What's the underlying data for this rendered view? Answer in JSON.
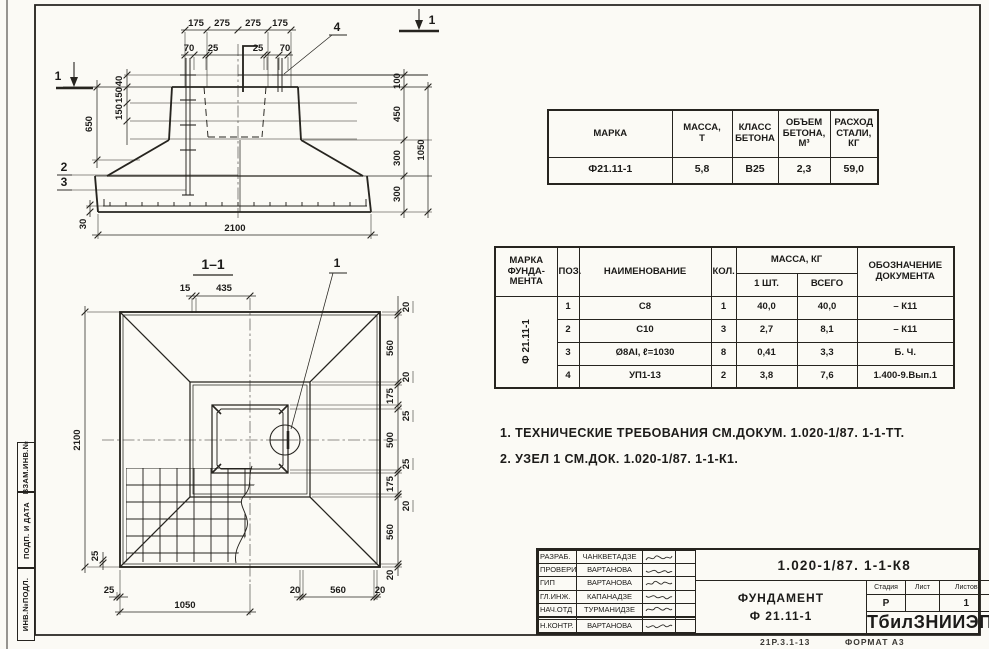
{
  "drawing": {
    "section_mark_label": "1",
    "elevation": {
      "top_row1": [
        "175",
        "275",
        "275",
        "175"
      ],
      "top_row2": [
        "70",
        "25",
        "25",
        "70"
      ],
      "callout_4": "4",
      "callout_2": "2",
      "callout_3": "3",
      "dim_40": "40",
      "dim_150a": "150",
      "dim_150b": "150",
      "dim_650": "650",
      "dim_30": "30",
      "dim_100": "100",
      "dim_450": "450",
      "dim_300a": "300",
      "dim_300b": "300",
      "dim_1050": "1050",
      "dim_2100": "2100"
    },
    "plan": {
      "title": "1–1",
      "callout_1": "1",
      "dim_15": "15",
      "dim_435": "435",
      "dim_2100": "2100",
      "dim_25_left": "25",
      "bottom": [
        "25",
        "1050",
        "20",
        "560",
        "20"
      ],
      "right": [
        "20",
        "560",
        "20",
        "175",
        "25",
        "500",
        "25",
        "175",
        "20",
        "560",
        "20"
      ]
    }
  },
  "summary_table": {
    "headers": [
      "МАРКА",
      "МАССА,\nТ",
      "КЛАСС\nБЕТОНА",
      "ОБЪЕМ\nБЕТОНА,\nМ³",
      "РАСХОД\nСТАЛИ,\nКГ"
    ],
    "row": [
      "Ф21.11-1",
      "5,8",
      "В25",
      "2,3",
      "59,0"
    ]
  },
  "spec_table": {
    "headers": {
      "mark": "МАРКА\nФУНДА-\nМЕНТА",
      "pos": "ПОЗ.",
      "name": "НАИМЕНОВАНИЕ",
      "qty": "КОЛ.",
      "mass": "МАССА, КГ",
      "mass_one": "1 ШТ.",
      "mass_all": "ВСЕГО",
      "doc": "ОБОЗНАЧЕНИЕ\nДОКУМЕНТА"
    },
    "mark_value": "Ф 21.11-1",
    "rows": [
      {
        "pos": "1",
        "name": "С8",
        "qty": "1",
        "one": "40,0",
        "all": "40,0",
        "doc": "– К11"
      },
      {
        "pos": "2",
        "name": "С10",
        "qty": "3",
        "one": "2,7",
        "all": "8,1",
        "doc": "– К11"
      },
      {
        "pos": "3",
        "name": "Ø8АI, ℓ=1030",
        "qty": "8",
        "one": "0,41",
        "all": "3,3",
        "doc": "Б. Ч."
      },
      {
        "pos": "4",
        "name": "УП1-13",
        "qty": "2",
        "one": "3,8",
        "all": "7,6",
        "doc": "1.400-9.Вып.1"
      }
    ]
  },
  "notes": [
    "1. ТЕХНИЧЕСКИЕ ТРЕБОВАНИЯ СМ.ДОКУМ. 1.020-1/87. 1-1-ТТ.",
    "2. УЗЕЛ 1 СМ.ДОК. 1.020-1/87. 1-1-К1."
  ],
  "titleblock": {
    "doc_number": "1.020-1/87. 1-1-К8",
    "title_line1": "ФУНДАМЕНТ",
    "title_line2": "Ф 21.11-1",
    "org": "ТбилЗНИИЭП",
    "stage_label": "Стадия",
    "sheet_label": "Лист",
    "sheets_label": "Листов",
    "stage_value": "Р",
    "sheet_value": "",
    "sheets_value": "1",
    "roles": [
      {
        "role": "РАЗРАБ.",
        "name": "ЧАНКВЕТАДЗЕ"
      },
      {
        "role": "ПРОВЕРИЛ",
        "name": "ВАРТАНОВА"
      },
      {
        "role": "ГИП",
        "name": "ВАРТАНОВА"
      },
      {
        "role": "ГЛ.ИНЖ.",
        "name": "КАПАНАДЗЕ"
      },
      {
        "role": "НАЧ.ОТД",
        "name": "ТУРМАНИДЗЕ"
      },
      {
        "role": "",
        "name": ""
      },
      {
        "role": "",
        "name": ""
      },
      {
        "role": "Н.КОНТР.",
        "name": "ВАРТАНОВА"
      }
    ]
  },
  "margin": {
    "labels": [
      "ВЗАМ.ИНВ.№",
      "ПОДП. И ДАТА",
      "ИНВ.№ПОДЛ."
    ]
  },
  "footer": {
    "left_note": "21Р.3.1-13",
    "format_note": "ФОРМАТ А3"
  }
}
